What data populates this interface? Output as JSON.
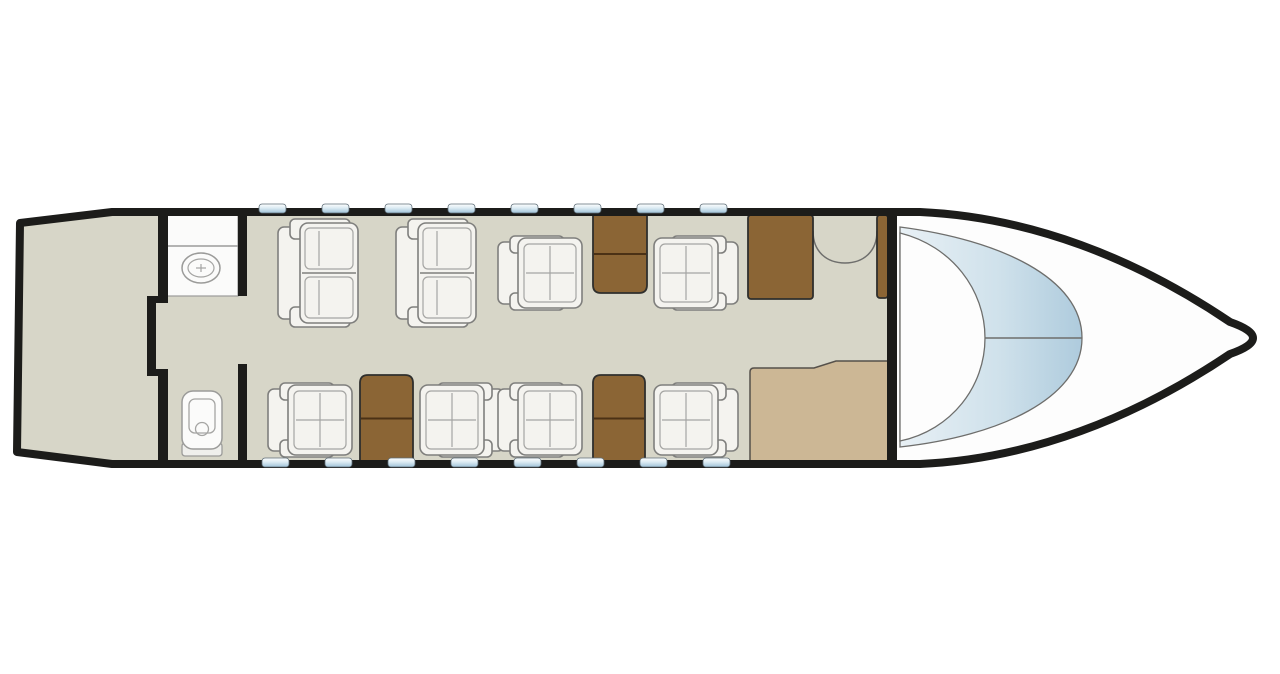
{
  "app": {
    "name": "Private jet cabin floor plan"
  },
  "canvas": {
    "width": 1280,
    "height": 674,
    "background": "#ffffff"
  },
  "colors": {
    "outline": "#1c1c1a",
    "floor": "#d7d6c8",
    "cockpit_floor": "#fdfdfd",
    "wood": "#8b6535",
    "wood_line": "#4b3115",
    "wood_stroke": "#2f2f2d",
    "counter_tan": "#ccb795",
    "counter_stroke": "#55504a",
    "furniture_fill": "#f4f3ef",
    "furniture_stroke": "#7f7f7d",
    "furniture_seam": "#a5a5a3",
    "fixture_fill": "#fbfbfa",
    "fixture_stroke": "#9b9b99",
    "line_gray": "#6e6e6c",
    "window_blue_dark": "#9fc3d9",
    "window_blue_mid": "#dcebf3",
    "window_white": "#fdfefe",
    "glass_light": "#e8f0f5",
    "glass_mid": "#cfe1eb",
    "glass_deep": "#aecbdd"
  },
  "fuselage": {
    "outline_width": 8,
    "outer_path": "M 20,223 L 112,212 L 920,212 C 1030,217 1135,258 1230,322 Q 1253,330 1253,338 Q 1253,346 1230,354 C 1135,418 1030,459 920,464 L 112,464 L 17,452 Z"
  },
  "walls": {
    "aft_bulkhead_rects": [
      [
        158,
        212,
        10,
        86
      ],
      [
        147,
        296,
        9,
        80
      ],
      [
        147,
        296,
        21,
        7
      ],
      [
        147,
        369,
        21,
        7
      ],
      [
        158,
        373,
        10,
        91
      ]
    ],
    "lav_forward_rects": [
      [
        238,
        212,
        9,
        84
      ],
      [
        238,
        364,
        9,
        100
      ]
    ],
    "cockpit_bulkhead_rect": [
      887,
      212,
      10,
      252
    ]
  },
  "lavatory": {
    "vanity": {
      "x": 167,
      "y": 212,
      "w": 71,
      "h": 84,
      "divider_y": 246
    },
    "sink": {
      "cx": 201,
      "cy": 268,
      "rx": 19,
      "ry": 15,
      "inner_rx": 13,
      "inner_ry": 9
    },
    "toilet": {
      "x": 180,
      "y": 391,
      "w": 44,
      "h": 66
    }
  },
  "cockpit": {
    "floor_x": 892,
    "windshield_outer_path": "M 900,227 C 1000,240 1082,278 1082,338 C 1082,398 1000,436 900,447 Z",
    "windshield_inner_path": "M 900,233 C 952,246 985,290 985,338 C 985,386 952,430 900,441 Z",
    "pane_divider": {
      "x1": 985,
      "y1": 338,
      "x2": 1082,
      "y2": 338
    }
  },
  "windows": {
    "w": 27,
    "h": 9,
    "r": 3,
    "top": {
      "y": 204,
      "xs": [
        259,
        322,
        385,
        448,
        511,
        574,
        637,
        700
      ]
    },
    "bottom": {
      "y": 458,
      "xs": [
        262,
        325,
        388,
        451,
        514,
        577,
        640,
        703
      ]
    }
  },
  "furniture": {
    "sofas": [
      {
        "id": "sofa-aft-1",
        "x": 278,
        "y": 219
      },
      {
        "id": "sofa-aft-2",
        "x": 396,
        "y": 219
      }
    ],
    "chairs": [
      {
        "id": "club-chair-1",
        "x": 268,
        "y": 383,
        "facing": "right"
      },
      {
        "id": "club-chair-2",
        "x": 420,
        "y": 383,
        "facing": "left"
      },
      {
        "id": "club-chair-3",
        "x": 498,
        "y": 236,
        "facing": "right"
      },
      {
        "id": "club-chair-4",
        "x": 654,
        "y": 236,
        "facing": "left"
      },
      {
        "id": "club-chair-5",
        "x": 498,
        "y": 383,
        "facing": "right"
      },
      {
        "id": "club-chair-6",
        "x": 654,
        "y": 383,
        "facing": "left"
      }
    ],
    "tables": [
      {
        "id": "side-table-top",
        "x": 593,
        "y": 215,
        "w": 54,
        "h": 78,
        "attach": "top"
      },
      {
        "id": "side-table-bottom-1",
        "x": 360,
        "y": 375,
        "w": 53,
        "h": 87,
        "attach": "bottom"
      },
      {
        "id": "side-table-bottom-2",
        "x": 593,
        "y": 375,
        "w": 52,
        "h": 87,
        "attach": "bottom"
      }
    ],
    "cabinets": [
      {
        "id": "galley-cabinet",
        "x": 748,
        "y": 215,
        "w": 65,
        "h": 84
      },
      {
        "id": "wardrobe-cabinet",
        "x": 877,
        "y": 215,
        "w": 11,
        "h": 83
      }
    ],
    "galley_counter_path": "M 750,464 L 750,372 Q 750,368 754,368 L 814,368 L 836,361 L 888,361 L 888,464 Z",
    "entry_arc_path": "M 813,231 C 813,252 827,263 845,263 C 863,263 877,252 877,231"
  },
  "inventory": {
    "sofa_count": 2,
    "club_chair_count": 6,
    "side_table_count": 3,
    "cabinet_count": 2,
    "window_count": 16,
    "lavatory_count": 1
  }
}
